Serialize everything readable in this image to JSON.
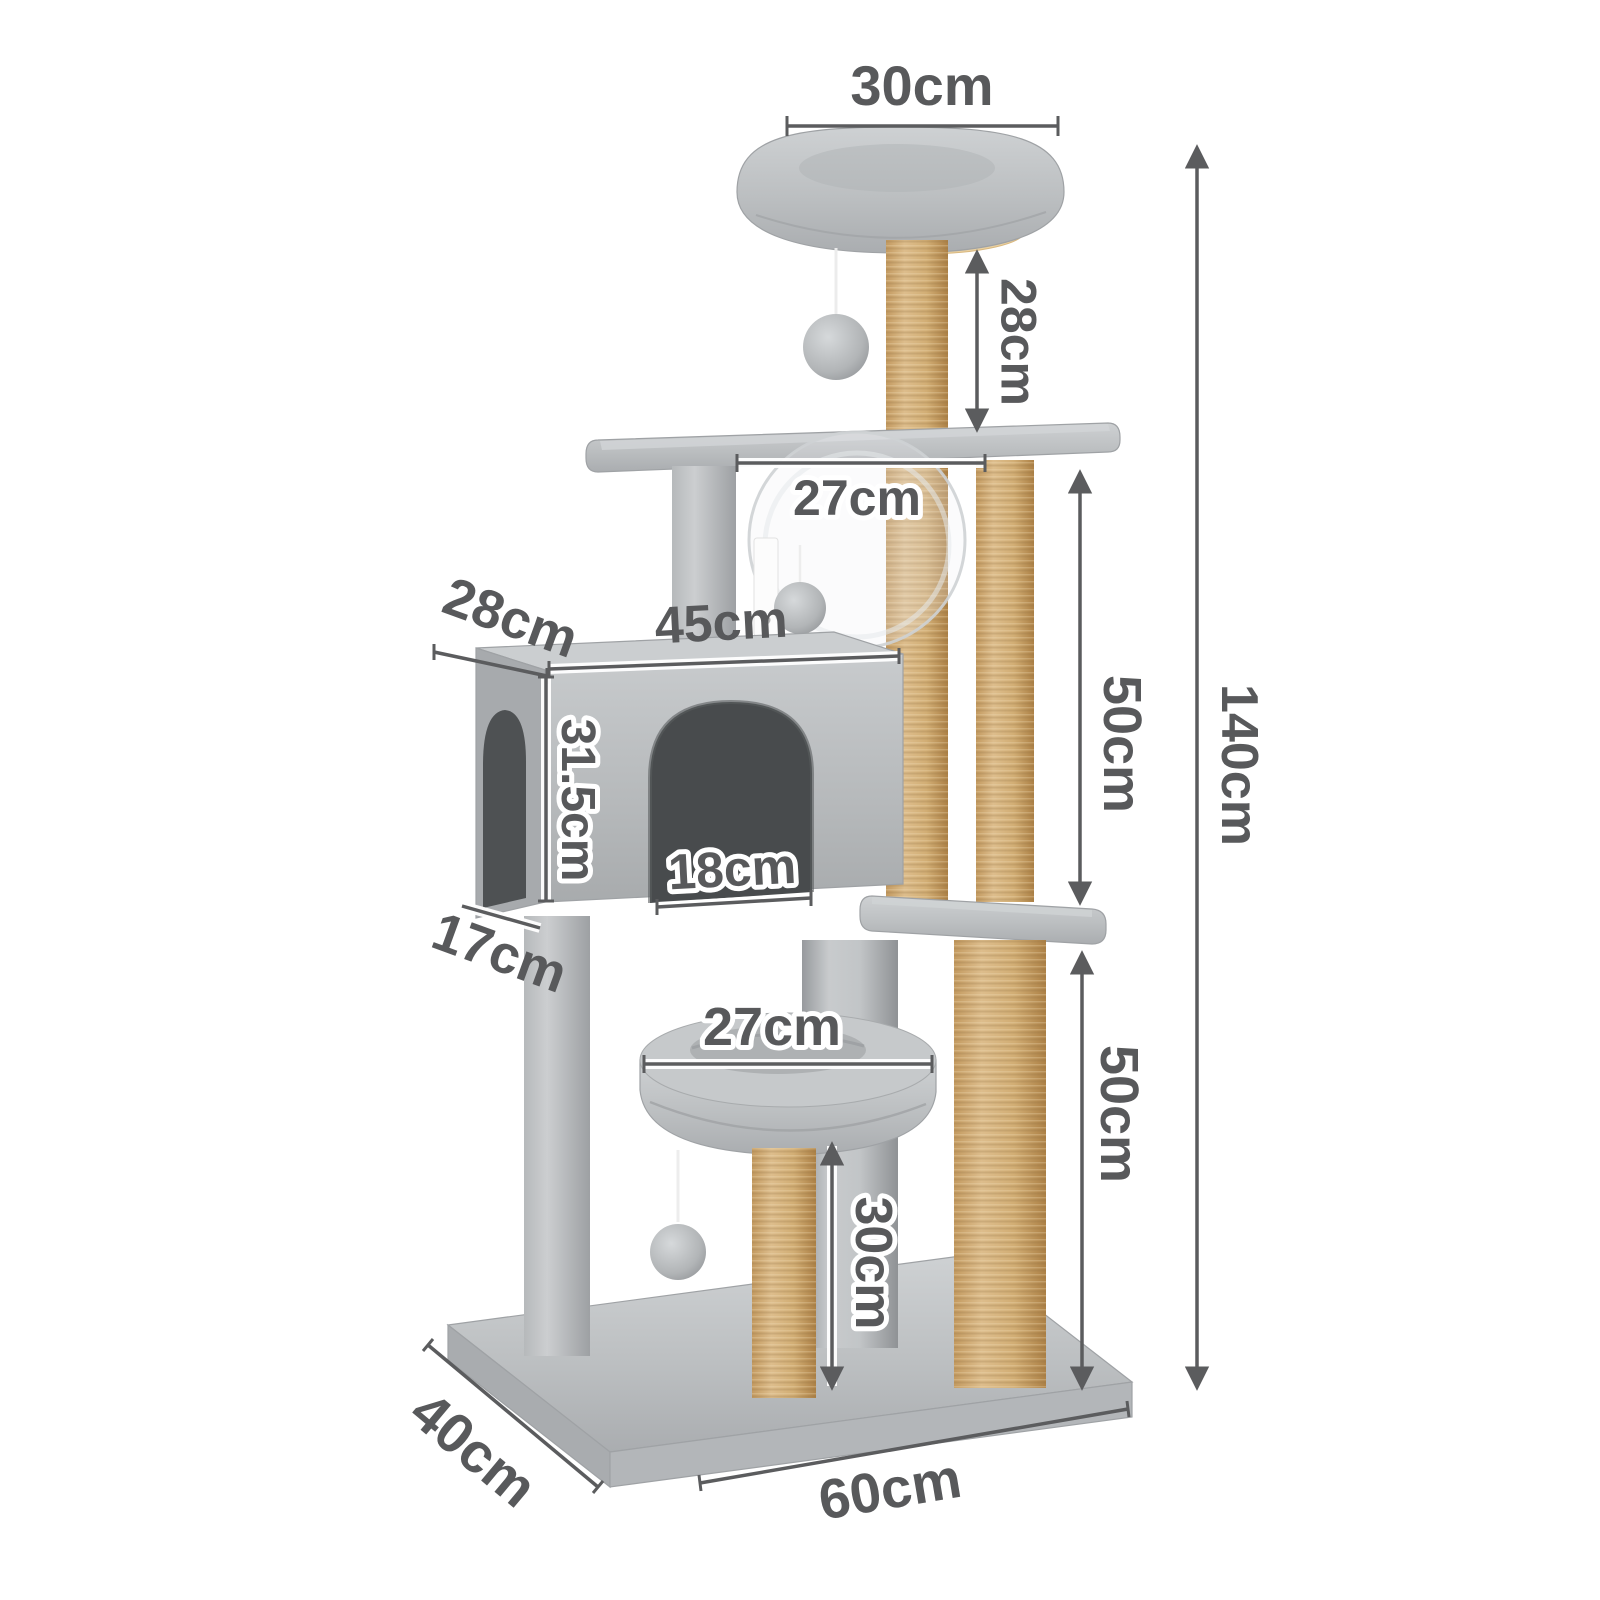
{
  "dims": {
    "top_bed_width": "30cm",
    "top_post_height": "28cm",
    "total_height": "140cm",
    "middle_platform_width": "27cm",
    "condo_top_depth": "28cm",
    "condo_width": "45cm",
    "condo_height": "31.5cm",
    "door_width": "18cm",
    "condo_bottom_depth": "17cm",
    "upper_post_height": "50cm",
    "lower_post_height": "50cm",
    "lower_bed_width": "27cm",
    "bottom_post_height": "30cm",
    "base_depth": "40cm",
    "base_width": "60cm"
  },
  "colors": {
    "background": "#ffffff",
    "plush_grey": "#bcbfc1",
    "plush_dark": "#a7aaad",
    "jute": "#d2ae75",
    "wood": "#ead1a2",
    "cave_interior": "#4b4e50",
    "dimension_text": "#58595b",
    "dimension_line": "#5b5c5e"
  }
}
